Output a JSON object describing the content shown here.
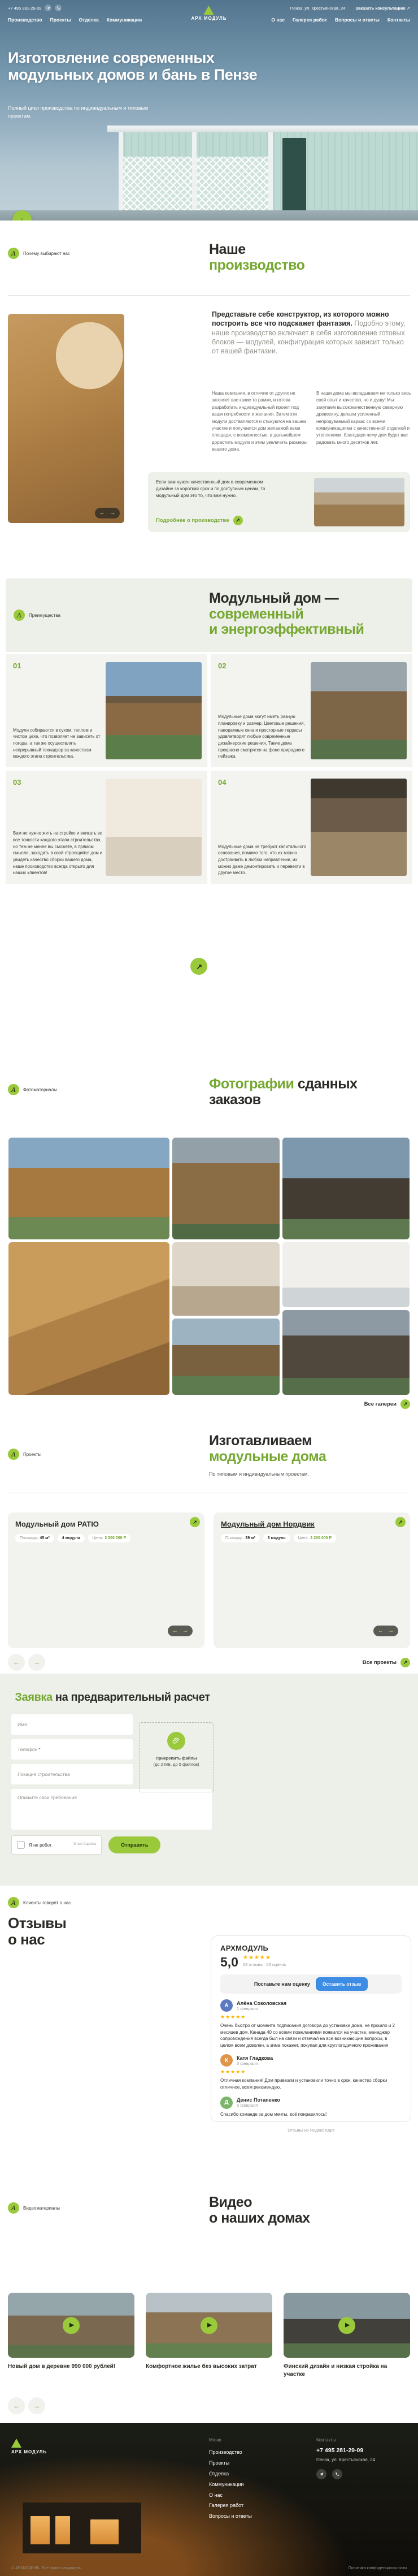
{
  "colors": {
    "accent": "#9bc93c",
    "heading_green": "#76a832",
    "dark": "#2b2b27",
    "review_btn_blue": "#3d8de5",
    "stars_yellow": "#ffb800"
  },
  "header": {
    "phone": "+7 495 281-29-09",
    "address": "Пенза, ул. Крестьянская, 24",
    "consult": "Заказать консультацию",
    "consult_arrow": "↗",
    "logo": "АРХ МОДУЛЬ",
    "nav_left": [
      "Производство",
      "Проекты",
      "Отделка",
      "Коммуникации"
    ],
    "nav_right": [
      "О нас",
      "Галерея работ",
      "Вопросы и ответы",
      "Контакты"
    ]
  },
  "hero": {
    "title": "Изготовление современных модульных домов и бань в Пензе",
    "subtitle": "Полный цикл производства по индивидуальным и типовым проектам.",
    "scroll_arrow": "↓"
  },
  "production": {
    "badge": "Почему выбирают нас",
    "title1": "Наше",
    "title2": "производство",
    "lead_bold": "Представьте себе конструктор, из которого можно построить все что подскажет фантазия.",
    "lead_rest": " Подобно этому, наше производство включает в себя изготовление готовых блоков — модулей, конфигурация которых зависит только от вашей фантазии.",
    "col1": "Наша компания, в отличие от других не загоняет вас какие то рамки, и готова разработать индивидуальный проект под ваши потребности и желания. Затем эти модули доставляются и стыкуются на вашем участке и получается дом желаемой вами площади, с возможностью, в дальнейшем дорастить модули и этим увеличить размеры вашего дома.",
    "col2": "В наши дома мы вкладываем не только весь свой опыт и качество, но и душу! Мы закупаем высококачественную северную древесину, делаем усиленный, непродуваемый каркас со всеми коммуникациями с качественной отделкой и утеплением, благодаря чему дом будет вас радовать много десятков лет.",
    "card_text": "Если вам нужен качественный дом в современном дизайне за короткий срок и по доступным ценам, то модульный дом это то, что вам нужно.",
    "card_link": "Подробнее о производстве",
    "arrow_left": "←",
    "arrow_right": "→",
    "arrow_upright": "↗"
  },
  "advantages": {
    "badge": "Преимущества",
    "title1": "Модульный дом —",
    "title2": "современный",
    "title3": "и энергоэффективный",
    "items": [
      {
        "num": "01",
        "text": "Модули собираются в сухом, теплом и чистом цехе, что позволяет не зависеть от погоды, а так же осуществлять непрерывный технадзор за качеством каждого этапа строительства."
      },
      {
        "num": "02",
        "text": "Модульные дома могут иметь разную планировку и размер. Цветовые решения, панорамные окна и просторные террасы удовлетворят любые современные дизайнерские решения. Такие дома прекрасно смотрятся на фоне природного пейзажа."
      },
      {
        "num": "03",
        "text": "Вам не нужно жить на стройке и вникать во все тонкости каждого этапа строительства, но тем не менее вы сможете, в прямом смысле, заходить в свой строящийся дом и увидеть качество сборки вашего дома, наше производство всегда открыто для наших клиентов!"
      },
      {
        "num": "04",
        "text": "Модульные дома не требуют капитального основания, помимо того, что их можно достраивать в любом направлении, их можно даже демонтировать и перевезти в другое место."
      }
    ],
    "cta_word1": "Закажите",
    "cta_word2": "модульный",
    "cta_line2": "дом своей мечты",
    "cta_arrow": "↗"
  },
  "gallery": {
    "badge": "Фотоматериалы",
    "title1": "Фотографии",
    "title2": "сданных",
    "title3": "заказов",
    "link": "Все галереи",
    "link_arrow": "↗"
  },
  "projects": {
    "badge": "Проекты",
    "title1": "Изготавливаем",
    "title2": "модульные дома",
    "subtitle": "По типовым и индивидуальным проектам.",
    "link": "Все проекты",
    "cards": [
      {
        "title": "Модульный дом PATIO",
        "area_label": "Площадь:",
        "area": "45 м²",
        "modules": "4 модуля",
        "price_label": "Цена:",
        "price": "2 500 000 Р"
      },
      {
        "title": "Модульный дом Нордвик",
        "area_label": "Площадь:",
        "area": "39 м²",
        "modules": "3 модуля",
        "price_label": "Цена:",
        "price": "2 200 000 Р"
      }
    ]
  },
  "form": {
    "title1": "Заявка",
    "title2": " на предварительный расчет",
    "fields": {
      "name": "Имя",
      "phone": "Телефон",
      "phone_required": "*",
      "location": "Локация строительства",
      "message": "Опишите свои требования"
    },
    "attach": "Прикрепить файлы",
    "attach_note": "(до 2 МБ, до 5 файлов)",
    "captcha_label": "Я не робот",
    "captcha_brand": "Smart Captcha",
    "submit": "Отправить"
  },
  "reviews": {
    "badge": "Клиенты говорят о нас",
    "title1": "Отзывы",
    "title2": "о нас",
    "widget": {
      "company": "АРХМОДУЛЬ",
      "rating": "5,0",
      "stars": "★★★★★",
      "meta": "53 отзыва · 55 оценок",
      "prompt": "Поставьте нам оценку",
      "leave_btn": "Оставить отзыв",
      "source": "Отзывы из Яндекс Карт",
      "items": [
        {
          "avatar": "А",
          "name": "Алёна Соколовская",
          "date": "1 февраля",
          "stars": "★★★★★",
          "text": "Очень быстро от момента подписания договора до установки дома, не прошло и 2 месяцев дом. Канада 40 со всеми пожеланиями появился на участке, менеджер сопровождения всегда был на связи и отвечал на все возникающие вопросы, в целом всем доволен, а зима покажет, покупал для круглогодичного проживания"
        },
        {
          "avatar": "К",
          "name": "Катя Гладкова",
          "date": "3 февраля",
          "stars": "★★★★★",
          "text": "Отличная компания! Дом привезли и установили точно в срок, качество сборки отличное, всем рекомендую."
        },
        {
          "avatar": "Д",
          "name": "Денис Потапенко",
          "date": "5 февраля",
          "stars": "★★★★★",
          "text": "Спасибо команде за дом мечты, всё понравилось!"
        }
      ]
    }
  },
  "videos": {
    "badge": "Видеоматериалы",
    "title1": "Видео",
    "title2": "о наших домах",
    "items": [
      {
        "title": "Новый дом в деревне 990 000 рублей!"
      },
      {
        "title": "Комфортное жилье без высоких затрат"
      },
      {
        "title": "Финский дизайн и низкая стройка на участке"
      }
    ]
  },
  "footer": {
    "logo": "АРХ МОДУЛЬ",
    "menu_title": "Меню",
    "menu": [
      "Производство",
      "Проекты",
      "Отделка",
      "Коммуникации",
      "О нас",
      "Галерея работ",
      "Вопросы и ответы"
    ],
    "contacts_title": "Контакты",
    "phone": "+7 495 281-29-09",
    "address": "Пенза, ул. Крестьянская, 24",
    "copyright": "© АРХМОДУЛЬ. Все права защищены",
    "policy": "Политика конфиденциальности"
  }
}
